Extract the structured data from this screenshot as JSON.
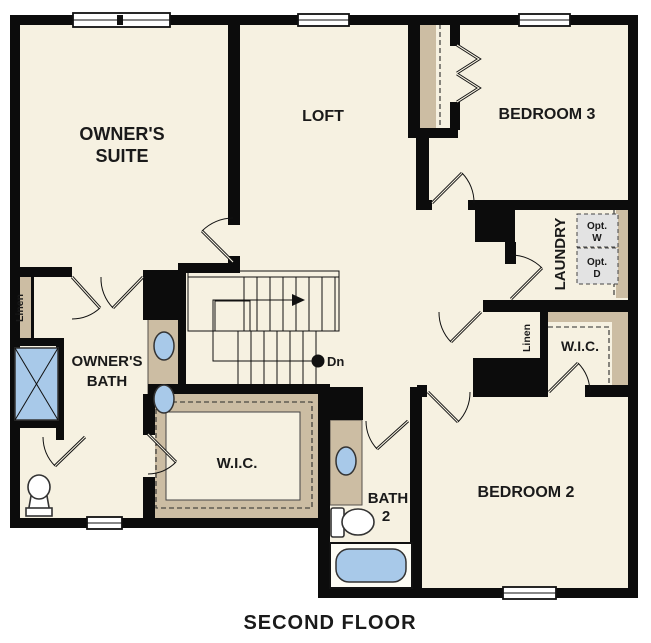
{
  "title": "SECOND FLOOR",
  "colors": {
    "background": "#ffffff",
    "floor": "#f6f1e1",
    "wall": "#0c0c0c",
    "casework_tan": "#ccbda3",
    "fixture_blue": "#a8c9e9",
    "appliance_gray": "#e3e3e3",
    "text": "#1a1a1a"
  },
  "rooms": {
    "owner_suite": {
      "label_line1": "OWNER'S",
      "label_line2": "SUITE"
    },
    "loft": {
      "label": "LOFT"
    },
    "bedroom3": {
      "label": "BEDROOM 3"
    },
    "laundry": {
      "label": "LAUNDRY",
      "opt_washer_line1": "Opt.",
      "opt_washer_line2": "W",
      "opt_dryer_line1": "Opt.",
      "opt_dryer_line2": "D"
    },
    "owner_bath": {
      "label_line1": "OWNER'S",
      "label_line2": "BATH"
    },
    "owner_wic": {
      "label": "W.I.C."
    },
    "bedroom2_wic": {
      "label": "W.I.C."
    },
    "bath2": {
      "label_line1": "BATH",
      "label_line2": "2"
    },
    "bedroom2": {
      "label": "BEDROOM 2"
    },
    "linen_left": {
      "label": "Linen"
    },
    "linen_right": {
      "label": "Linen"
    },
    "stairs": {
      "down_label": "Dn"
    }
  }
}
